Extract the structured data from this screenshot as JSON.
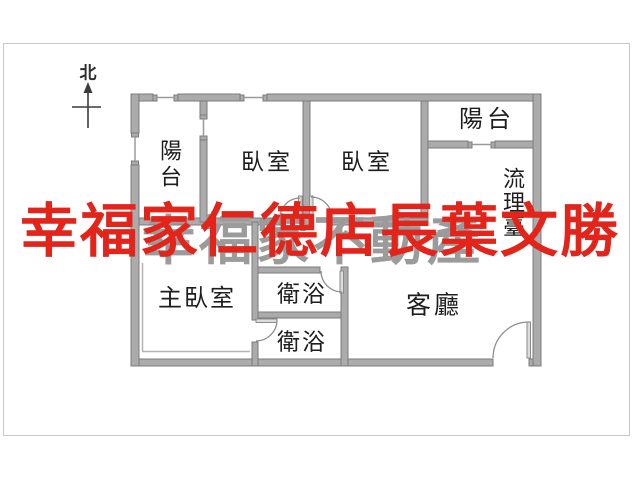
{
  "compass": {
    "label": "北"
  },
  "rooms": {
    "balcony_left": {
      "label": "陽台"
    },
    "bedroom_1": {
      "label": "臥室"
    },
    "bedroom_2": {
      "label": "臥室"
    },
    "balcony_right": {
      "label": "陽台"
    },
    "kitchen_counter": {
      "label": "流理臺"
    },
    "master_bedroom": {
      "label": "主臥室"
    },
    "bathroom_1": {
      "label": "衛浴"
    },
    "bathroom_2": {
      "label": "衛浴"
    },
    "living_room": {
      "label": "客廳"
    }
  },
  "watermark": {
    "red_text": "幸福家仁德店長葉文勝",
    "red_color": "#e2241b",
    "gray_text": "幸福家不動產",
    "gray_color": "#9b9b9b"
  },
  "colors": {
    "wall_fill": "#ababab",
    "wall_stroke": "#7b7b7b",
    "frame": "#c9c9c9"
  }
}
